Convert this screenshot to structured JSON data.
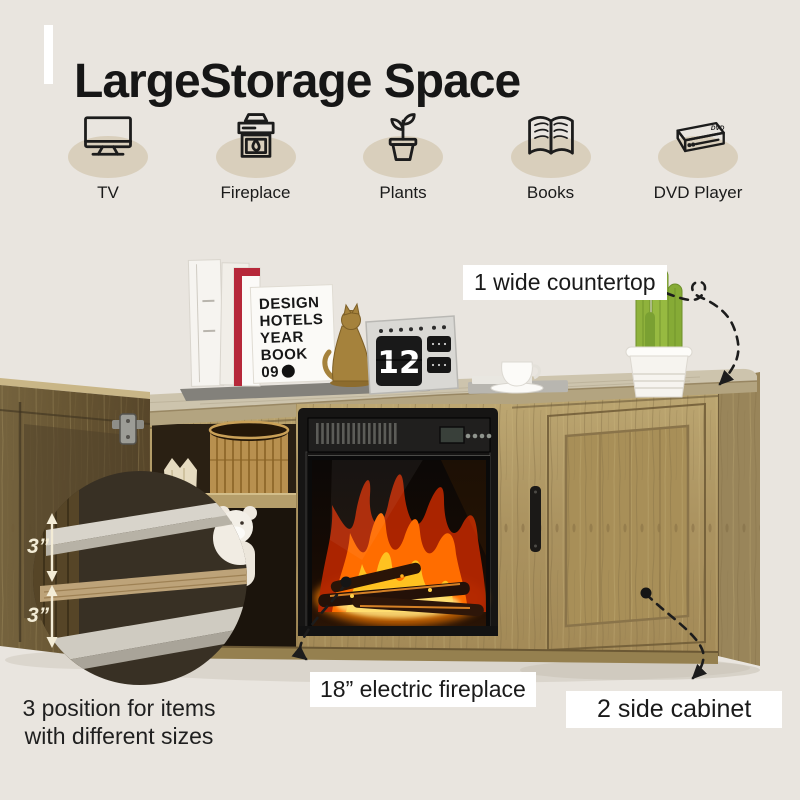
{
  "header": {
    "title": "LargeStorage Space"
  },
  "features": {
    "items": [
      {
        "label": "TV",
        "icon": "tv-icon"
      },
      {
        "label": "Fireplace",
        "icon": "fireplace-icon"
      },
      {
        "label": "Plants",
        "icon": "plant-icon"
      },
      {
        "label": "Books",
        "icon": "books-icon"
      },
      {
        "label": "DVD Player",
        "icon": "dvd-player-icon",
        "badge": "DVD"
      }
    ]
  },
  "annotations": {
    "countertop": "1 wide countertop",
    "fireplace": "18” electric fireplace",
    "side_cabinet": "2 side cabinet",
    "positions_line1": "3 position for items",
    "positions_line2": "with different sizes",
    "shelf_gap_top": "3”",
    "shelf_gap_bottom": "3”"
  },
  "decor": {
    "book_lines": [
      "DESIGN",
      "HOTELS",
      "YEAR",
      "BOOK",
      "09"
    ],
    "calendar_day": "12"
  },
  "colors": {
    "background": "#e9e5df",
    "title_text": "#161616",
    "icon_ellipse": "#d9cfbc",
    "icon_stroke": "#1c1c1c",
    "label_background": "#ffffff",
    "label_text": "#1a1a1a",
    "arrow": "#1c1c1c",
    "measurement_text": "#f3ecd6",
    "wood": "#ab9565",
    "wood_top": "#cdc4ad",
    "fire_orange": "#ff6d00",
    "fire_yellow": "#ffc220",
    "insert_black": "#161514"
  }
}
